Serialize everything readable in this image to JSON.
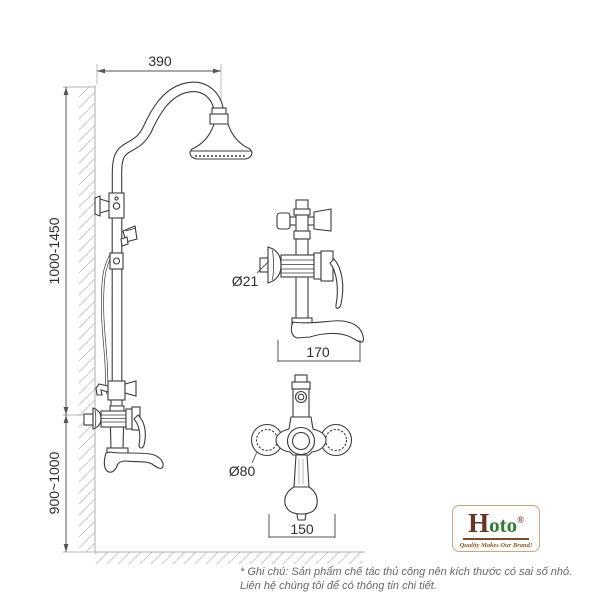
{
  "diagram": {
    "dimensions": {
      "top_width": "390",
      "upper_height": "1000-1450",
      "lower_height": "900~1000",
      "valve_diameter": "Ø21",
      "valve_depth": "170",
      "handle_diameter": "Ø80",
      "valve_width": "150"
    },
    "colors": {
      "line_art": "#3b3b3b",
      "construction": "#b5b5b5",
      "dimension_text": "#2e2e2e"
    }
  },
  "logo": {
    "initial": "H",
    "rest": "oto",
    "registered": "®",
    "tagline": "Quality Makes Our Brand!",
    "colors": {
      "initial": "#6b3423",
      "rest": "#2e7d32",
      "border": "#c9a87c",
      "tagline": "#8a5a2b"
    }
  },
  "footnote": {
    "line1": "* Ghi chú: Sản phẩm chế tác thủ công nên kích thước có sai số nhỏ.",
    "line2": "Liên hệ chúng tôi để có thông tin chi tiết."
  }
}
